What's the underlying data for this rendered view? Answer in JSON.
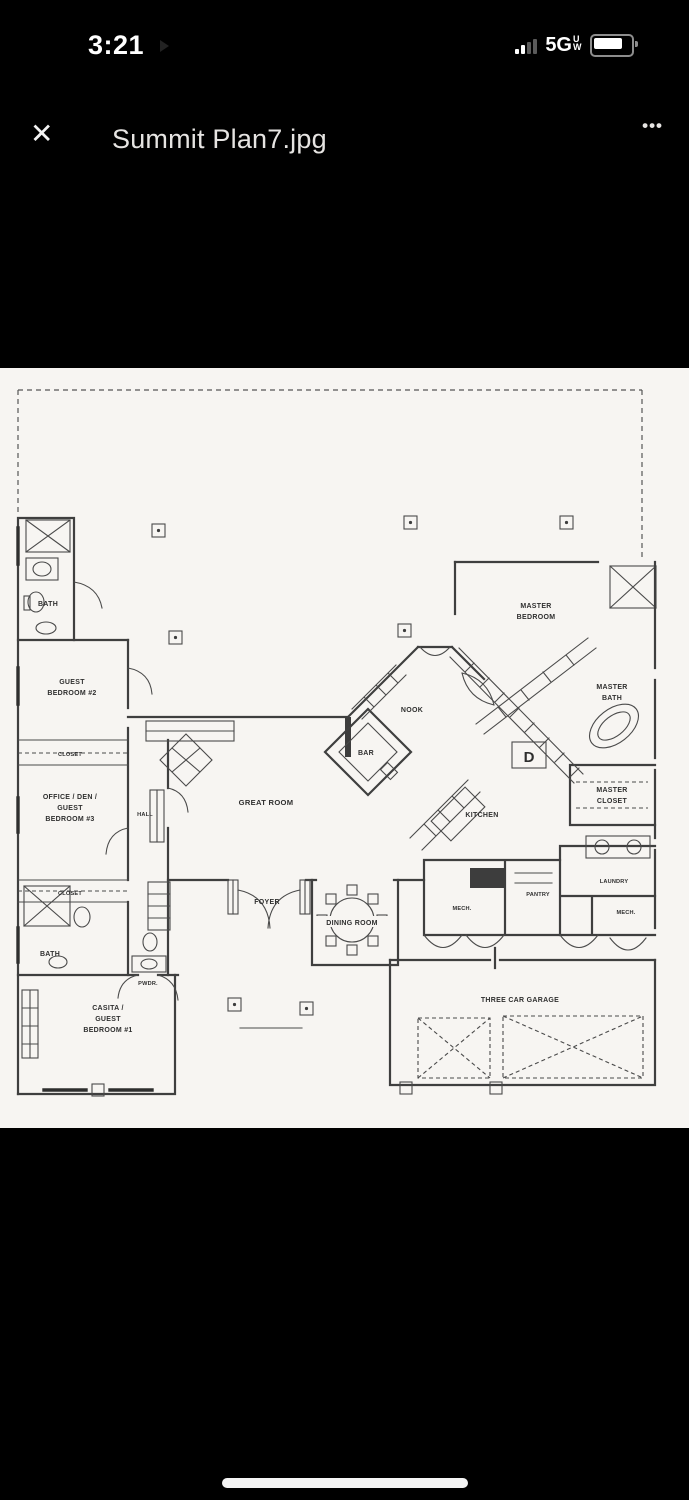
{
  "status_bar": {
    "time": "3:21",
    "network": "5G",
    "network_sub": "UW"
  },
  "header": {
    "close_icon": "✕",
    "title": "Summit Plan7.jpg",
    "more_icon": "•••"
  },
  "plan": {
    "rooms": {
      "bath_upper": "BATH",
      "guest2_l1": "GUEST",
      "guest2_l2": "BEDROOM #2",
      "closet_upper": "CLOSET",
      "office_l1": "OFFICE / DEN /",
      "office_l2": "GUEST",
      "office_l3": "BEDROOM #3",
      "hall": "HALL",
      "closet_lower": "CLOSET",
      "bath_lower": "BATH",
      "pwdr": "PWDR.",
      "casita_l1": "CASITA /",
      "casita_l2": "GUEST",
      "casita_l3": "BEDROOM #1",
      "great_room": "GREAT ROOM",
      "bar": "BAR",
      "nook": "NOOK",
      "master_l1": "MASTER",
      "master_l2": "BEDROOM",
      "master_bath_l1": "MASTER",
      "master_bath_l2": "BATH",
      "master_closet_l1": "MASTER",
      "master_closet_l2": "CLOSET",
      "kitchen": "KITCHEN",
      "foyer": "FOYER",
      "dining": "DINING ROOM",
      "mech_left": "MECH.",
      "pantry": "PANTRY",
      "laundry": "LAUNDRY",
      "mech_right": "MECH.",
      "garage": "THREE CAR GARAGE",
      "appliance_d": "D"
    },
    "colors": {
      "paper": "#f7f5f2",
      "ink": "#3f3f3f",
      "background": "#000000",
      "header_text": "#e6e4e2"
    }
  }
}
